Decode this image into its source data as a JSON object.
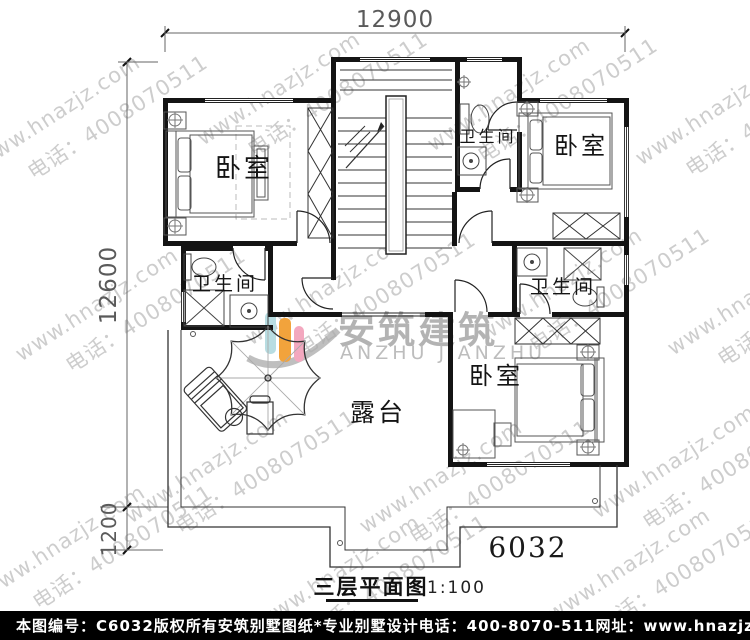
{
  "dimensions": {
    "top_width": "12900",
    "left_height": "12600",
    "left_lower": "1200"
  },
  "rooms": {
    "bedroom_upper_left": "卧室",
    "bedroom_upper_right": "卧室",
    "bedroom_lower_right": "卧室",
    "bath_top": "卫生间",
    "bath_left": "卫生间",
    "bath_right": "卫生间",
    "terrace": "露台"
  },
  "plan_number": "6032",
  "caption": {
    "title": "三层平面图",
    "scale": "1:100"
  },
  "watermark": {
    "line1": "www.hnazjz.com",
    "line2": "电话：4008070511"
  },
  "logo": {
    "cn": "安筑建筑",
    "en": "ANZHU JIANZHU",
    "colors": {
      "cyan": "#b8dde2",
      "orange": "#f2a33c",
      "pink": "#f3a8bf",
      "gray": "#a9a9a9"
    }
  },
  "footer": {
    "bg": "#000000",
    "fg": "#ffffff",
    "sheet_id": "本图编号：C6032",
    "copyright": "版权所有",
    "brand": "安筑别墅图纸*专业别墅设计",
    "phone": "电话：400-8070-511",
    "website": "网址：www.hnazjz.com"
  }
}
